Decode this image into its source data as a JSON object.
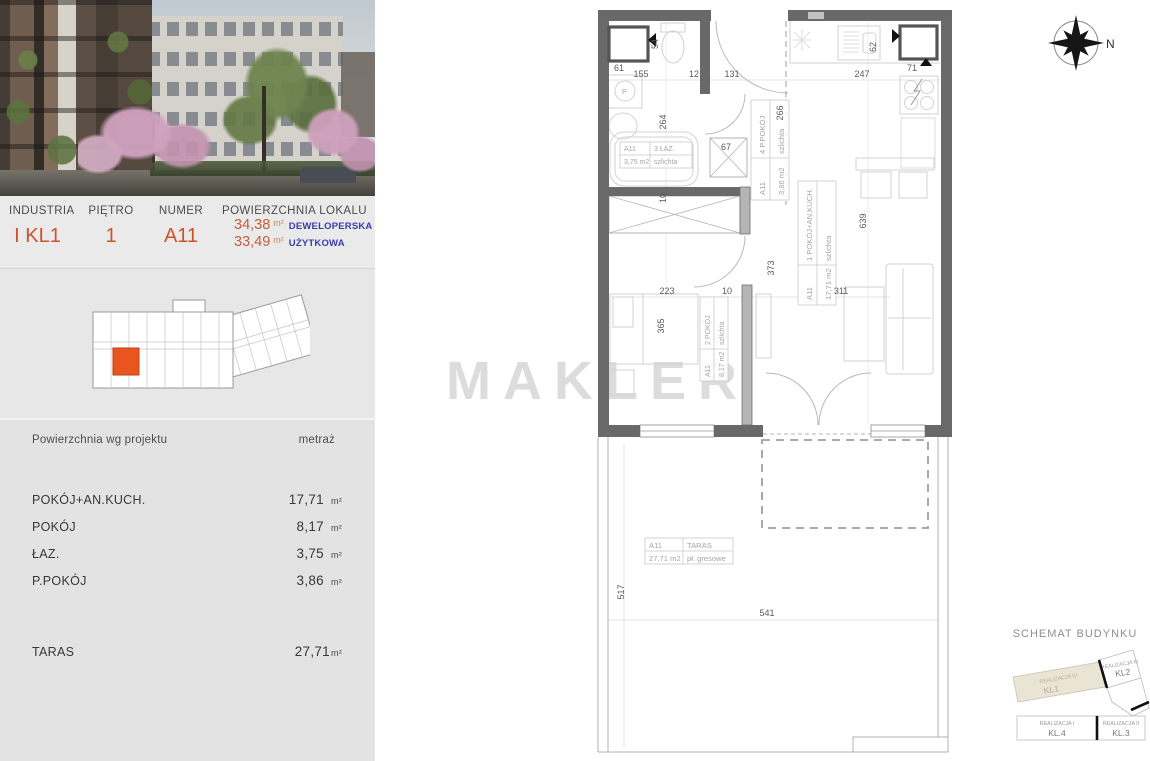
{
  "left_panel": {
    "photo_name": "building-exterior-render",
    "header": {
      "columns": [
        {
          "label": "INDUSTRIA",
          "value": "I KL1"
        },
        {
          "label": "PIĘTRO",
          "value": "1"
        },
        {
          "label": "NUMER",
          "value": "A11"
        }
      ],
      "area": {
        "label": "POWIERZCHNIA LOKALU",
        "rows": [
          {
            "value": "34,38",
            "unit": "m²",
            "kind": "DEWELOPERSKA"
          },
          {
            "value": "33,49",
            "unit": "m²",
            "kind": "UŻYTKOWA"
          }
        ]
      }
    },
    "table": {
      "col_name": "Powierzchnia wg projektu",
      "col_value": "metraż",
      "rows": [
        {
          "name": "POKÓJ+AN.KUCH.",
          "value": "17,71",
          "unit": "m²"
        },
        {
          "name": "POKÓJ",
          "value": "8,17",
          "unit": "m²"
        },
        {
          "name": "ŁAZ.",
          "value": "3,75",
          "unit": "m²"
        },
        {
          "name": "P.POKÓJ",
          "value": "3,86",
          "unit": "m²"
        }
      ],
      "terrace": {
        "name": "TARAS",
        "value": "27,71",
        "unit": "m²"
      }
    }
  },
  "watermark": "MAKLER",
  "compass": {
    "north": "N"
  },
  "plan": {
    "washer_label": "P",
    "dims": [
      "61",
      "54",
      "155",
      "12",
      "131",
      "247",
      "62",
      "71",
      "264",
      "67",
      "266",
      "10",
      "373",
      "223",
      "10",
      "365",
      "311",
      "639",
      "517",
      "541"
    ],
    "labels": {
      "laz": {
        "id": "A11",
        "name": "3 ŁAZ.",
        "area": "3,75 m2",
        "finish": "szlichta"
      },
      "ppokoj": {
        "id": "A11",
        "name": "4 P.POKÓJ",
        "area": "3,86 m2",
        "finish": "szlichta"
      },
      "pokoj_kuch": {
        "id": "A11",
        "name": "1 POKÓJ+AN.KUCH.",
        "area": "17,71 m2",
        "finish": "szlichta"
      },
      "pokoj": {
        "id": "A11",
        "name": "2 POKÓJ",
        "area": "8,17 m2",
        "finish": "szlichta"
      },
      "taras": {
        "id": "A11",
        "name": "TARAS",
        "area": "27,71 m2",
        "finish": "pł. gresowe"
      }
    }
  },
  "schemat": {
    "title": "SCHEMAT BUDYNKU",
    "wings": [
      {
        "name": "REALIZACJA IV",
        "kl": "KL1",
        "highlighted": true
      },
      {
        "name": "REALIZACJA III",
        "kl": "KL2",
        "highlighted": false
      },
      {
        "name": "REALIZACJA I",
        "kl": "KL.4",
        "highlighted": false
      },
      {
        "name": "REALIZACJA II",
        "kl": "KL.3",
        "highlighted": false
      }
    ]
  },
  "colors": {
    "accent_orange": "#d0512d",
    "accent_blue": "#3c3cae",
    "unit_highlight": "#e8551e",
    "wall_gray": "#696969"
  }
}
